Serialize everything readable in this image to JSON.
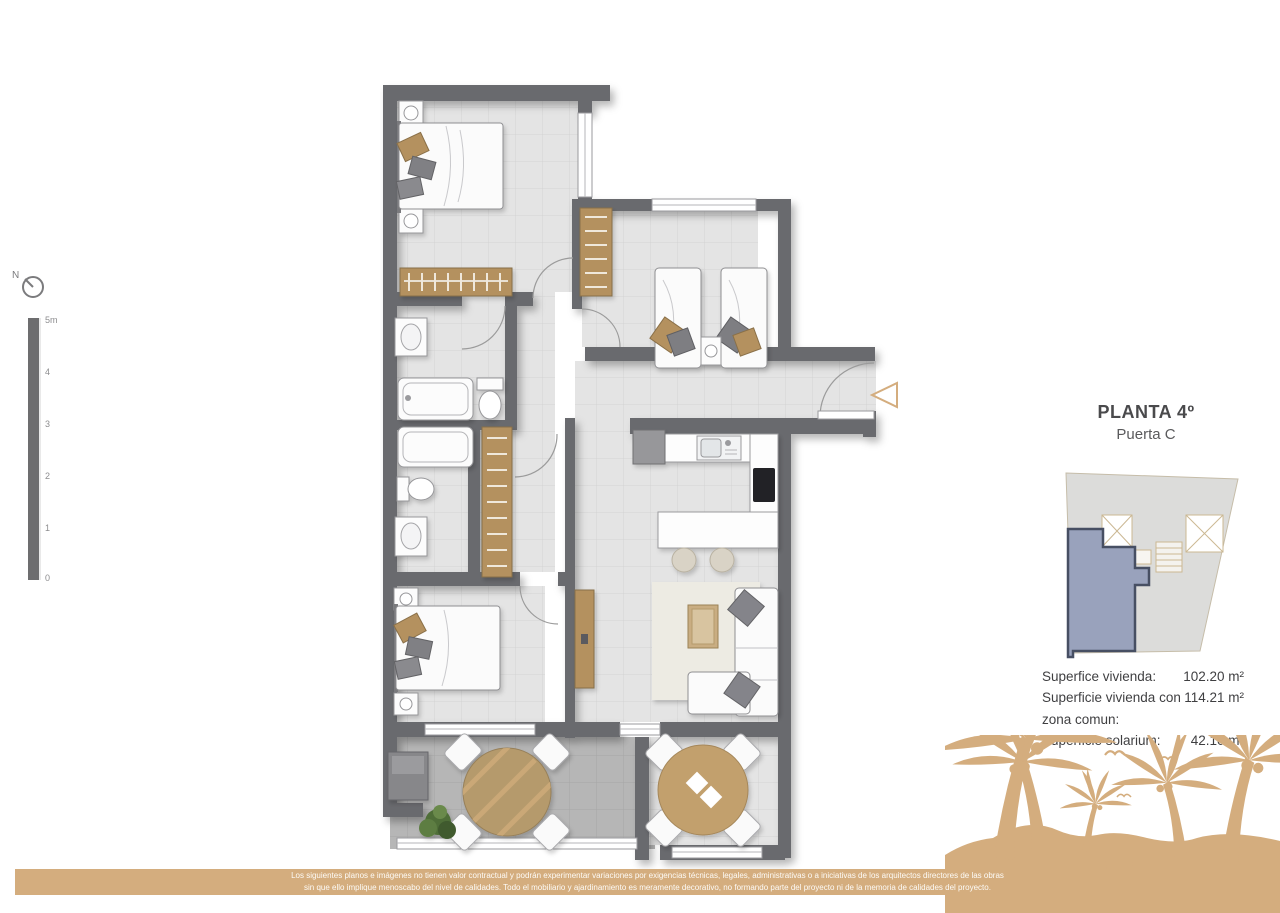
{
  "header": {
    "title": "PLANTA 4º",
    "subtitle": "Puerta C"
  },
  "surfaces": {
    "rows": [
      {
        "label": "Superfice vivienda:",
        "value": "102.20 m²"
      },
      {
        "label": "Superficie vivienda con zona comun:",
        "value": "114.21 m²"
      },
      {
        "label": "Superficie solarium:",
        "value": "42.10 m²"
      }
    ]
  },
  "scale_bar": {
    "ticks": [
      "5m",
      "4",
      "3",
      "2",
      "1",
      "0"
    ]
  },
  "compass": {
    "north_label": "N"
  },
  "footer": {
    "disclaimer_line1": "Los siguientes planos e imágenes no tienen valor contractual y podrán experimentar variaciones por exigencias técnicas, legales, administrativas o a iniciativas de los arquitectos directores de las obras",
    "disclaimer_line2": "sin que ello implique menoscabo del nivel de calidades. Todo el mobiliario y ajardinamiento es meramente decorativo, no formando parte del proyecto ni de la memoria de calidades del proyecto."
  },
  "colors": {
    "brand_tan": "#d4ad7e",
    "wall_gray": "#696a6e",
    "floor_light": "#e4e4e4",
    "terrace_dark": "#b6b6b6",
    "wood": "#b4915f",
    "unit_highlight": "#99a2bc"
  }
}
